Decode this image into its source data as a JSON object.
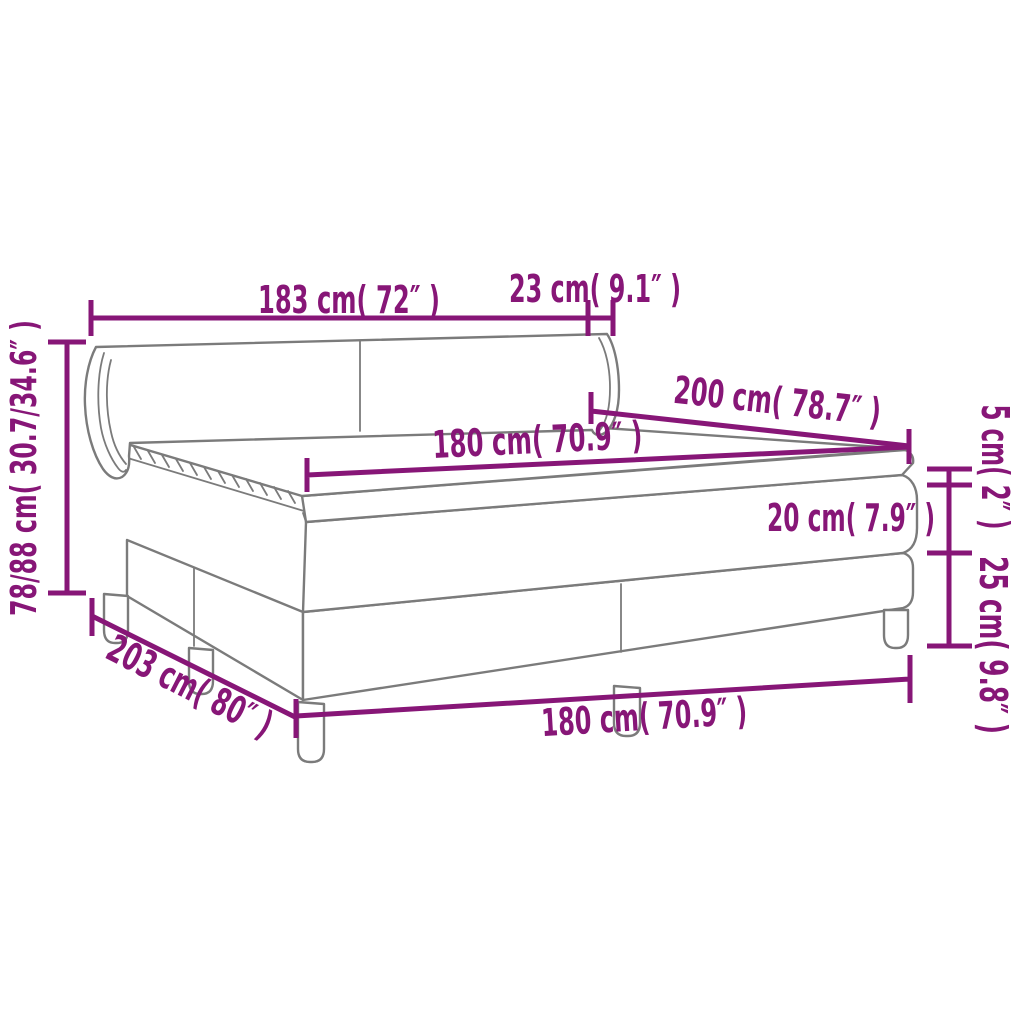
{
  "diagram": {
    "type": "product-dimension-line-drawing",
    "subject": "box spring bed with headboard, mattress and topper, six legs, perspective view",
    "colors": {
      "background": "#ffffff",
      "outline_gray": "#7b7b7b",
      "dimension_magenta": "#871677"
    },
    "labels": {
      "headboard_width": "183 cm( 72″ )",
      "wing_depth": "23 cm( 9.1″ )",
      "total_height": "78/88 cm( 30.7/34.6″ )",
      "mattress_length": "200 cm( 78.7″ )",
      "mattress_width_top": "180 cm( 70.9″ )",
      "topper_height": "5 cm( 2″ )",
      "mattress_height": "20 cm( 7.9″ )",
      "base_height": "25 cm( 9.8″ )",
      "base_length": "203 cm( 80″ )",
      "base_width_bottom": "180 cm( 70.9″ )"
    }
  }
}
